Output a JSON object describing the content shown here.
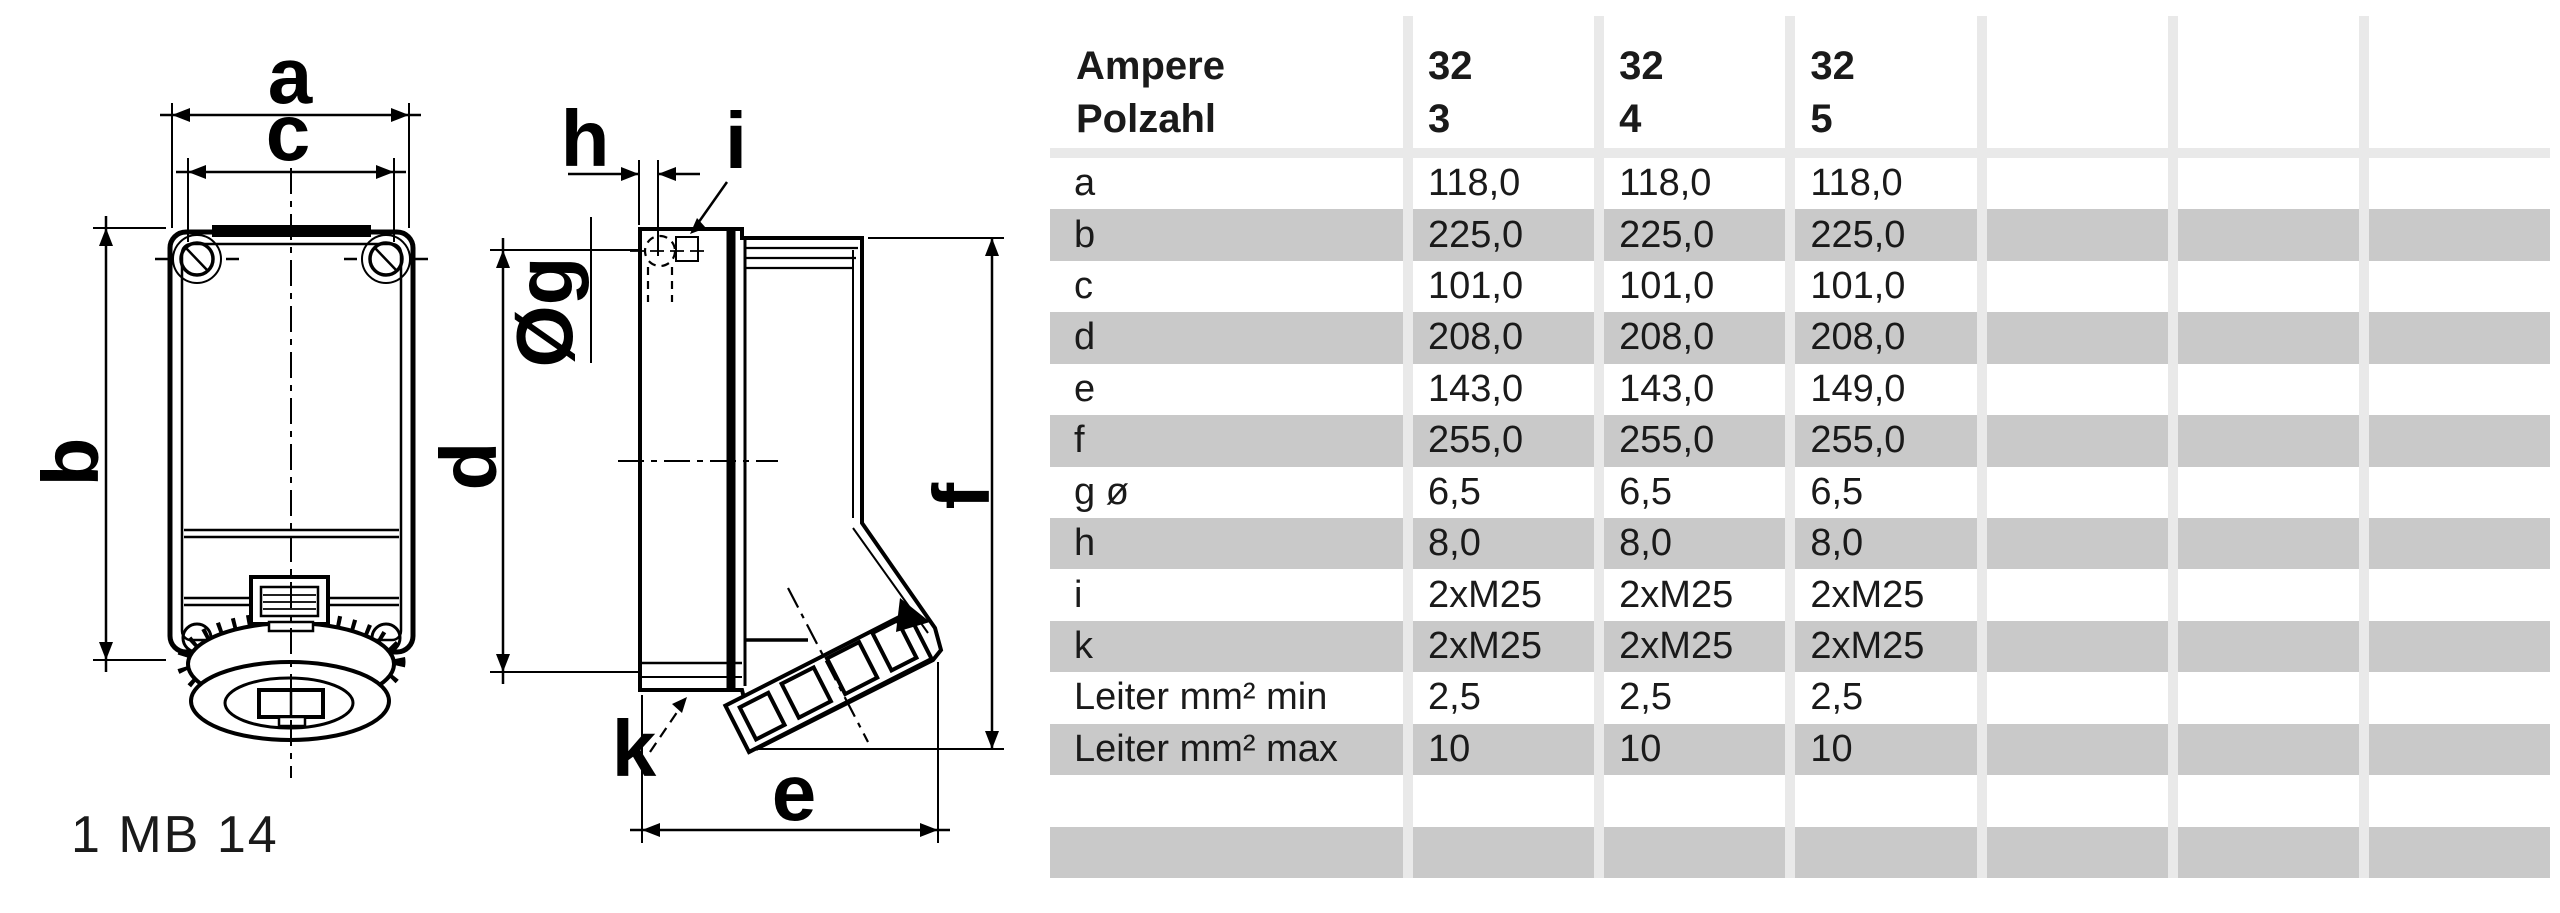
{
  "drawing": {
    "front": {
      "dim_a": "a",
      "dim_c": "c",
      "dim_b": "b",
      "model_label": "1 MB 14"
    },
    "side": {
      "dim_h": "h",
      "dim_i": "i",
      "dim_g": "Øg",
      "dim_d": "d",
      "dim_f": "f",
      "dim_k": "k",
      "dim_e": "e"
    }
  },
  "table": {
    "header_row1_label": "Ampere",
    "header_row2_label": "Polzahl",
    "header_columns": [
      {
        "ampere": "32",
        "polzahl": "3"
      },
      {
        "ampere": "32",
        "polzahl": "4"
      },
      {
        "ampere": "32",
        "polzahl": "5"
      },
      {
        "ampere": "",
        "polzahl": ""
      },
      {
        "ampere": "",
        "polzahl": ""
      },
      {
        "ampere": "",
        "polzahl": ""
      }
    ],
    "rows": [
      {
        "label": "a",
        "values": [
          "118,0",
          "118,0",
          "118,0",
          "",
          "",
          ""
        ]
      },
      {
        "label": "b",
        "values": [
          "225,0",
          "225,0",
          "225,0",
          "",
          "",
          ""
        ]
      },
      {
        "label": "c",
        "values": [
          "101,0",
          "101,0",
          "101,0",
          "",
          "",
          ""
        ]
      },
      {
        "label": "d",
        "values": [
          "208,0",
          "208,0",
          "208,0",
          "",
          "",
          ""
        ]
      },
      {
        "label": "e",
        "values": [
          "143,0",
          "143,0",
          "149,0",
          "",
          "",
          ""
        ]
      },
      {
        "label": "f",
        "values": [
          "255,0",
          "255,0",
          "255,0",
          "",
          "",
          ""
        ]
      },
      {
        "label": "g ø",
        "values": [
          "6,5",
          "6,5",
          "6,5",
          "",
          "",
          ""
        ]
      },
      {
        "label": "h",
        "values": [
          "8,0",
          "8,0",
          "8,0",
          "",
          "",
          ""
        ]
      },
      {
        "label": "i",
        "values": [
          "2xM25",
          "2xM25",
          "2xM25",
          "",
          "",
          ""
        ]
      },
      {
        "label": "k",
        "values": [
          "2xM25",
          "2xM25",
          "2xM25",
          "",
          "",
          ""
        ]
      },
      {
        "label": "Leiter mm² min",
        "values": [
          "2,5",
          "2,5",
          "2,5",
          "",
          "",
          ""
        ]
      },
      {
        "label": "Leiter mm² max",
        "values": [
          "10",
          "10",
          "10",
          "",
          "",
          ""
        ]
      },
      {
        "label": "",
        "values": [
          "",
          "",
          "",
          "",
          "",
          ""
        ]
      },
      {
        "label": "",
        "values": [
          "",
          "",
          "",
          "",
          "",
          ""
        ]
      }
    ],
    "colors": {
      "stripe": "#c9c9c9",
      "separator": "#e9e9e9",
      "ink": "#000000"
    }
  }
}
